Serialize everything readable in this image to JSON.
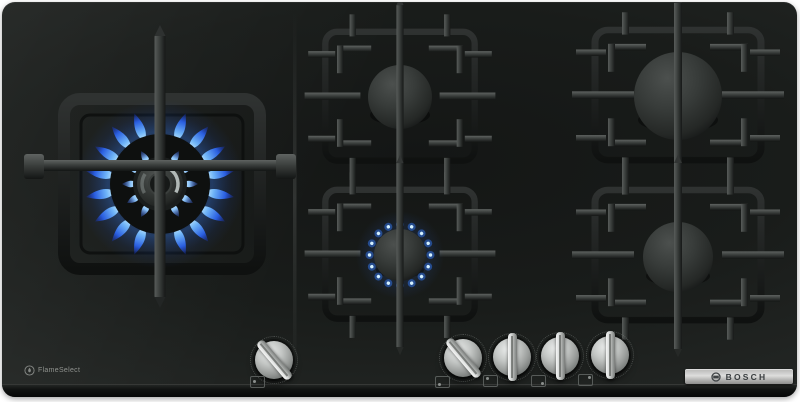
{
  "scene": {
    "description": "Black glass Bosch five-burner gas hob seen from above; large dual-ring wok burner on the left burning with blue flames, small centre-front burner lit, cast-iron pan supports over the right four burners, five stainless-steel control knobs along the front"
  },
  "branding": {
    "bosch_logo_text": "BOSCH",
    "flameselect_text": "FlameSelect"
  },
  "burners": [
    {
      "name": "left-wok-burner",
      "size": "large-dual-ring",
      "state": "on"
    },
    {
      "name": "center-rear-burner",
      "size": "medium",
      "state": "off"
    },
    {
      "name": "right-rear-burner",
      "size": "large",
      "state": "off"
    },
    {
      "name": "center-front-burner",
      "size": "small",
      "state": "on"
    },
    {
      "name": "right-front-burner",
      "size": "medium",
      "state": "off"
    }
  ],
  "knobs": [
    {
      "name": "knob-wok-burner",
      "state": "on",
      "icon_dot": "left"
    },
    {
      "name": "knob-center-front",
      "state": "on",
      "icon_dot": "bottom-left"
    },
    {
      "name": "knob-center-rear",
      "state": "off",
      "icon_dot": "top-left"
    },
    {
      "name": "knob-right-front",
      "state": "off",
      "icon_dot": "bottom-right"
    },
    {
      "name": "knob-right-rear",
      "state": "off",
      "icon_dot": "top-right"
    }
  ],
  "colors": {
    "glass_black": "#1b1d1c",
    "trivet_gray": "#3a3e3c",
    "flame_blue": "#2f6fe0",
    "flame_cyan": "#aee6ff",
    "knob_silver": "#c6c8c7",
    "bosch_bar_silver": "#c7c7c7",
    "bosch_text": "#3e4244"
  }
}
